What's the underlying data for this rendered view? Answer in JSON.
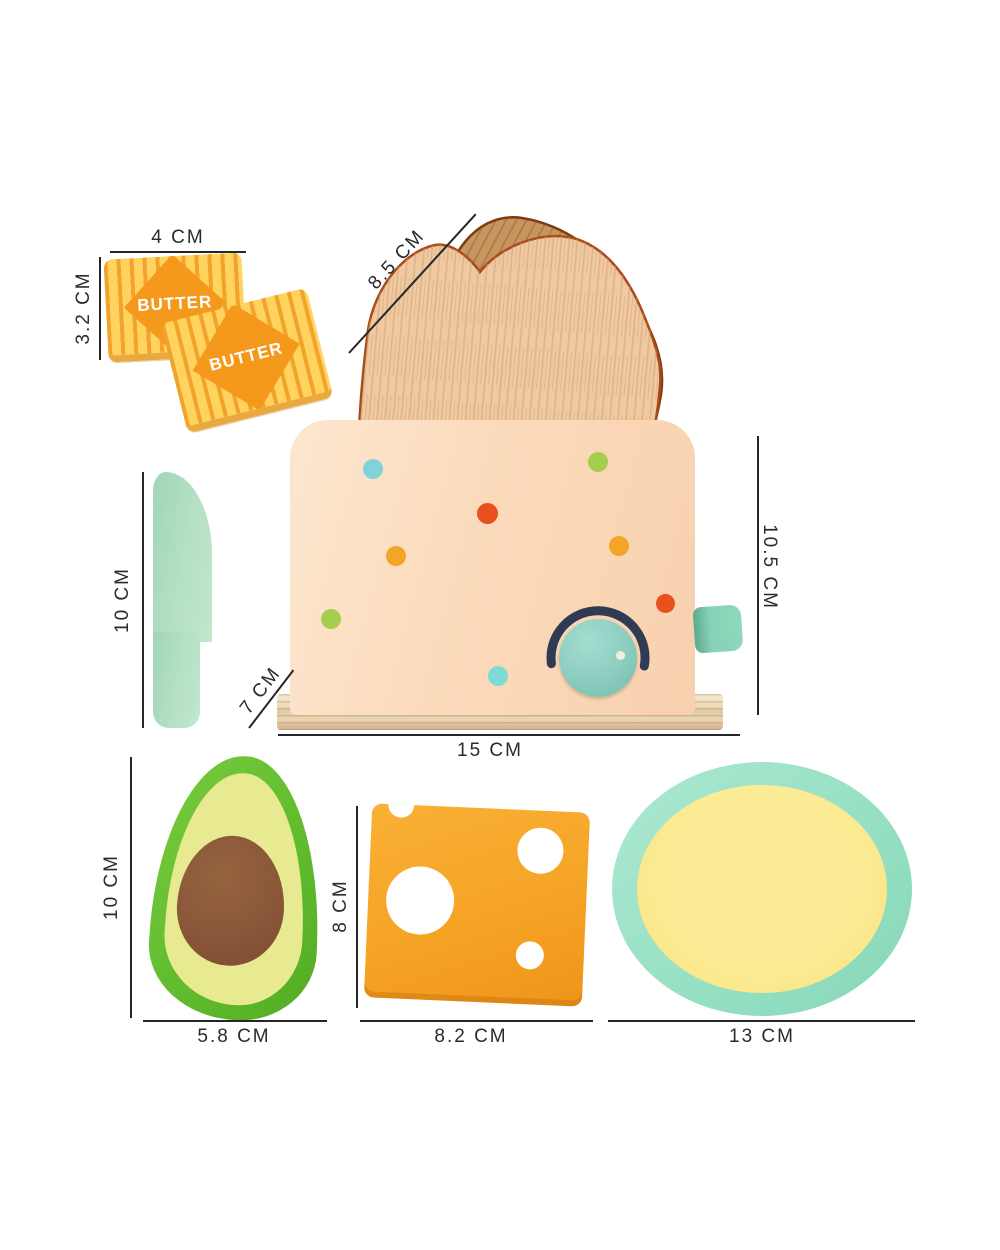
{
  "figure": {
    "type": "product dimension diagram"
  },
  "butter": {
    "face_label": "BUTTER"
  },
  "dims": {
    "butter_width": "4 CM",
    "butter_height": "3.2 CM",
    "toast_length": "8.5 CM",
    "toaster_depth": "7 CM",
    "toaster_width": "15 CM",
    "toaster_height": "10.5 CM",
    "knife_length": "10 CM",
    "avocado_height": "10 CM",
    "avocado_width": "5.8 CM",
    "cheese_height": "8 CM",
    "cheese_width": "8.2 CM",
    "plate_diameter": "13 CM"
  },
  "colors": {
    "butter_base": "#FFD35E",
    "butter_stripe": "#F2A32C",
    "butter_diamond": "#F5991D",
    "toast_front": "#EFC9A1",
    "toast_back": "#C7955F",
    "toast_outline": "#A84A1A",
    "toaster_body": "#FBDABB",
    "toaster_base_wood": "#EFDCBC",
    "knob": "#8FD0C2",
    "knob_ring": "#2E3B52",
    "lever": "#85D2B6",
    "dot_blue": "#7FD3DB",
    "dot_green": "#A6CE4E",
    "dot_red": "#E8501E",
    "dot_orange": "#F4A427",
    "dot_teal": "#7EDAD4",
    "knife": "#B5E0C4",
    "avocado_skin": "#63BE2F",
    "avocado_flesh": "#E7EA90",
    "avocado_pit": "#8A573A",
    "cheese": "#F5A224",
    "plate_rim": "#97E0C3",
    "plate_center": "#FAE483",
    "dimension_line": "#262626"
  }
}
